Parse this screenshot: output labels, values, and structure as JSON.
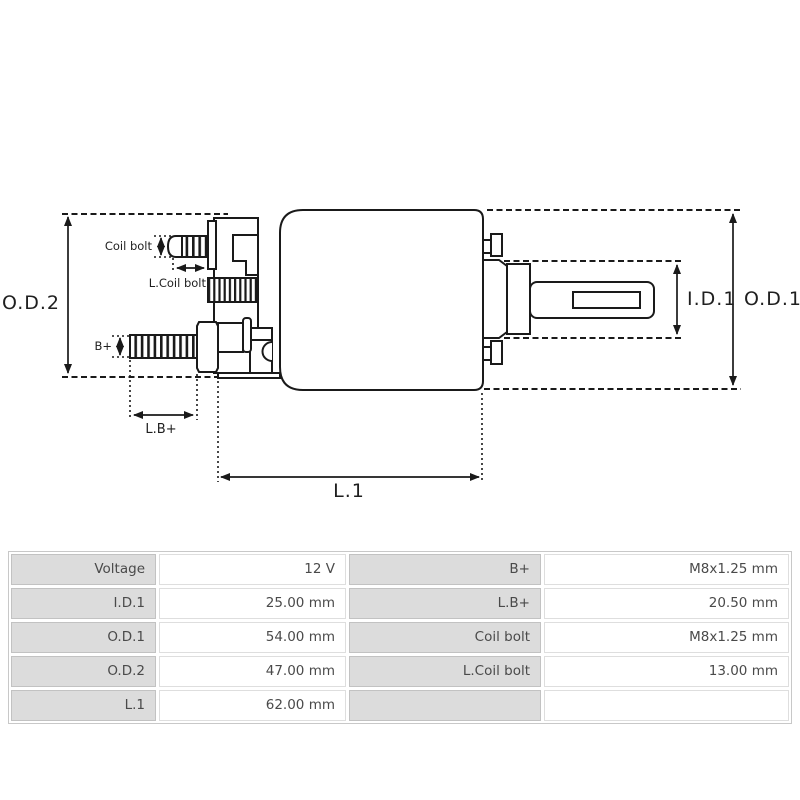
{
  "diagram": {
    "od2": "O.D.2",
    "od1": "O.D.1",
    "id1": "I.D.1",
    "l1": "L.1",
    "coil_bolt": "Coil bolt",
    "l_coil_bolt": "L.Coil bolt",
    "b_plus": "B+",
    "l_b_plus": "L.B+",
    "line_color": "#1a1a1a"
  },
  "table": {
    "label_bg": "#dcdcdc",
    "rows": [
      [
        "Voltage",
        "12 V",
        "B+",
        "M8x1.25 mm"
      ],
      [
        "I.D.1",
        "25.00 mm",
        "L.B+",
        "20.50 mm"
      ],
      [
        "O.D.1",
        "54.00 mm",
        "Coil bolt",
        "M8x1.25 mm"
      ],
      [
        "O.D.2",
        "47.00 mm",
        "L.Coil bolt",
        "13.00 mm"
      ],
      [
        "L.1",
        "62.00 mm",
        "",
        ""
      ]
    ]
  }
}
